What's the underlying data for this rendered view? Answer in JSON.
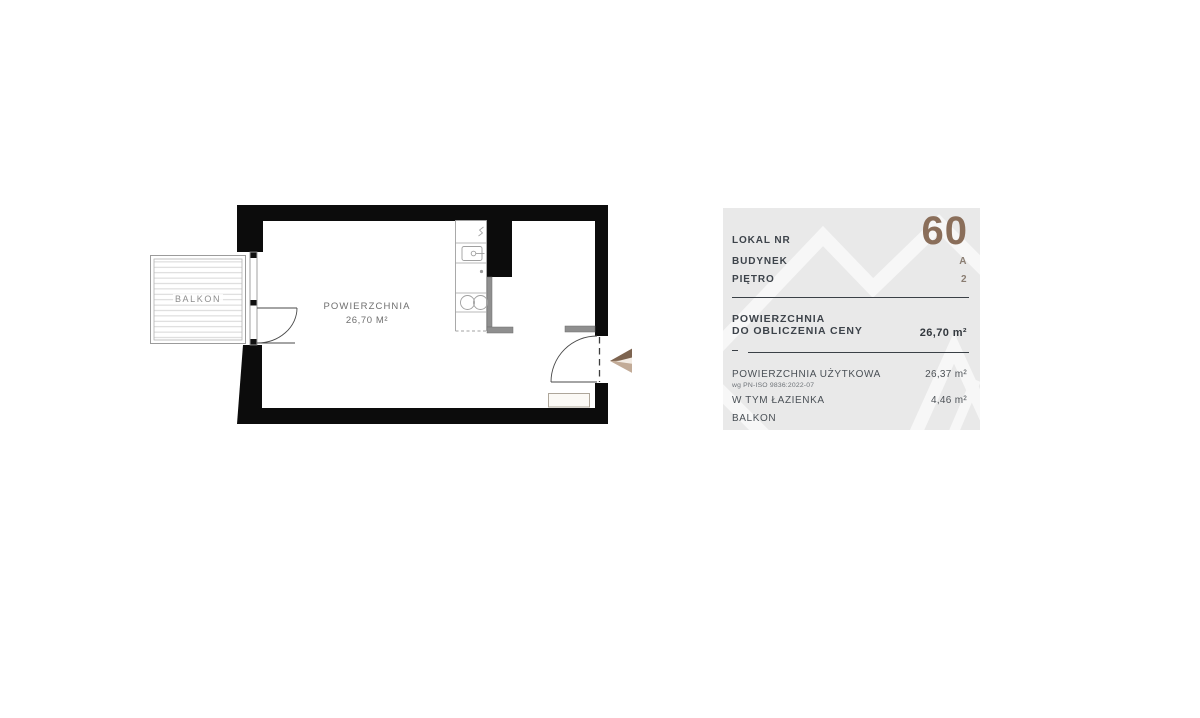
{
  "floorplan": {
    "balcony_label": "BALKON",
    "room": {
      "label": "POWIERZCHNIA",
      "area": "26,70 m²"
    },
    "colors": {
      "wall": "#0c0c0c",
      "partition": "#8f8f8f",
      "outline": "#9e9e9e",
      "hatch": "#d2d2d2",
      "label_text": "#6f6f6f",
      "arrow_dark": "#7d6450",
      "arrow_light": "#c2ab97"
    }
  },
  "panel": {
    "colors": {
      "background": "#e9e9e9",
      "accent_number": "#8a6e5a",
      "label": "#3d434a",
      "value_accent": "#8a7d72",
      "text_secondary": "#4d5257",
      "divider": "#3a4046",
      "watermark": "#ffffff"
    },
    "unit_number": {
      "label": "LOKAL NR",
      "value": "60"
    },
    "building": {
      "label": "BUDYNEK",
      "value": "A"
    },
    "floor": {
      "label": "PIĘTRO",
      "value": "2"
    },
    "price_area": {
      "label_line1": "POWIERZCHNIA",
      "label_line2": "DO OBLICZENIA CENY",
      "value": "26,70 m²"
    },
    "usable_area": {
      "label": "POWIERZCHNIA UŻYTKOWA",
      "note": "wg PN-ISO 9836:2022-07",
      "value": "26,37 m²"
    },
    "bathroom": {
      "label": "W TYM ŁAZIENKA",
      "value": "4,46 m²"
    },
    "balcony": {
      "label": "BALKON",
      "value": ""
    }
  }
}
